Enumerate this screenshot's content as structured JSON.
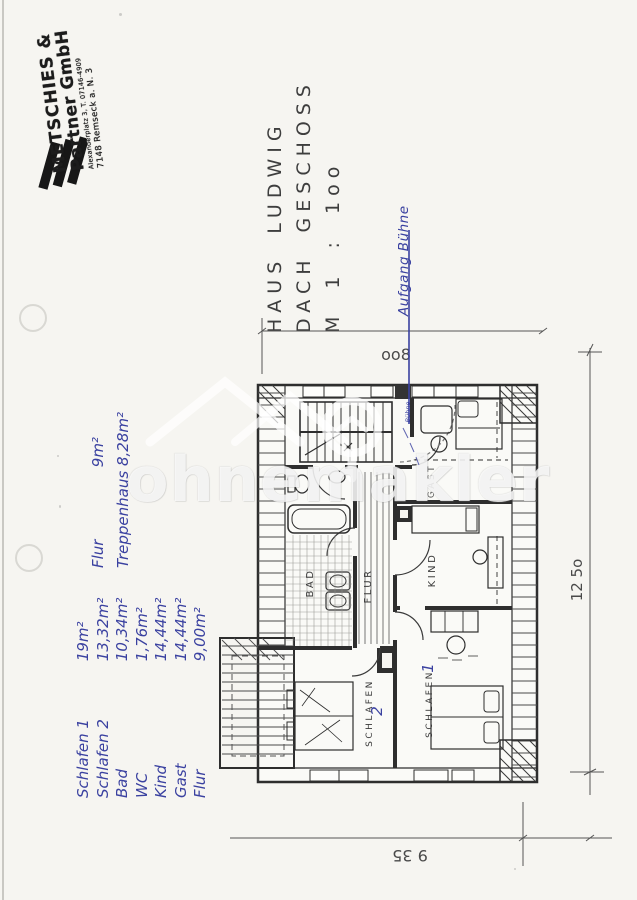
{
  "colors": {
    "paper": "#f6f5f1",
    "ink": "#2e2e2e",
    "blue_ink": "#3a41a0",
    "dimension": "#4a4a4a",
    "watermark_white": "rgba(255,255,255,0.78)"
  },
  "stamp": {
    "company_line1": "METSCHIES &",
    "company_line2": "Partner GmbH",
    "address_line": "Alexanderplatz 3, T. 07146-4909",
    "city_line": "7148 Remseck a. N. 3"
  },
  "title": {
    "line1": "HAUS LUDWIG",
    "line2": "DACH GESCHOSS",
    "line3": "M 1 : 1oo"
  },
  "annotations": {
    "aufgang_note": "Aufgang Bühne",
    "attic_note": "Bühne",
    "schlafen1_mark": "1",
    "schlafen2_mark": "2",
    "area_notes": [
      {
        "label": "Flur",
        "value": "9m²"
      },
      {
        "label": "Treppenhaus",
        "value": "8,28m²"
      }
    ],
    "room_areas": [
      {
        "label": "Schlafen 1",
        "value": "19m²"
      },
      {
        "label": "Schlafen 2",
        "value": "13,32m²"
      },
      {
        "label": "Bad",
        "value": "10,34m²"
      },
      {
        "label": "WC",
        "value": "1,76m²"
      },
      {
        "label": "Kind",
        "value": "14,44m²"
      },
      {
        "label": "Gast",
        "value": "14,44m²"
      },
      {
        "label": "Flur",
        "value": "9,00m²"
      }
    ]
  },
  "plan": {
    "room_labels": {
      "bad": "BAD",
      "flur": "FLUR",
      "kind": "KIND",
      "gast": "GAST",
      "schlafen_left": "SCHLAFEN",
      "schlafen_right": "SCHLAFEN"
    },
    "dimensions": {
      "top": "oo8",
      "right": "12 5o",
      "bottom": "9 35"
    }
  },
  "watermark": {
    "text": "ohnemakler"
  }
}
